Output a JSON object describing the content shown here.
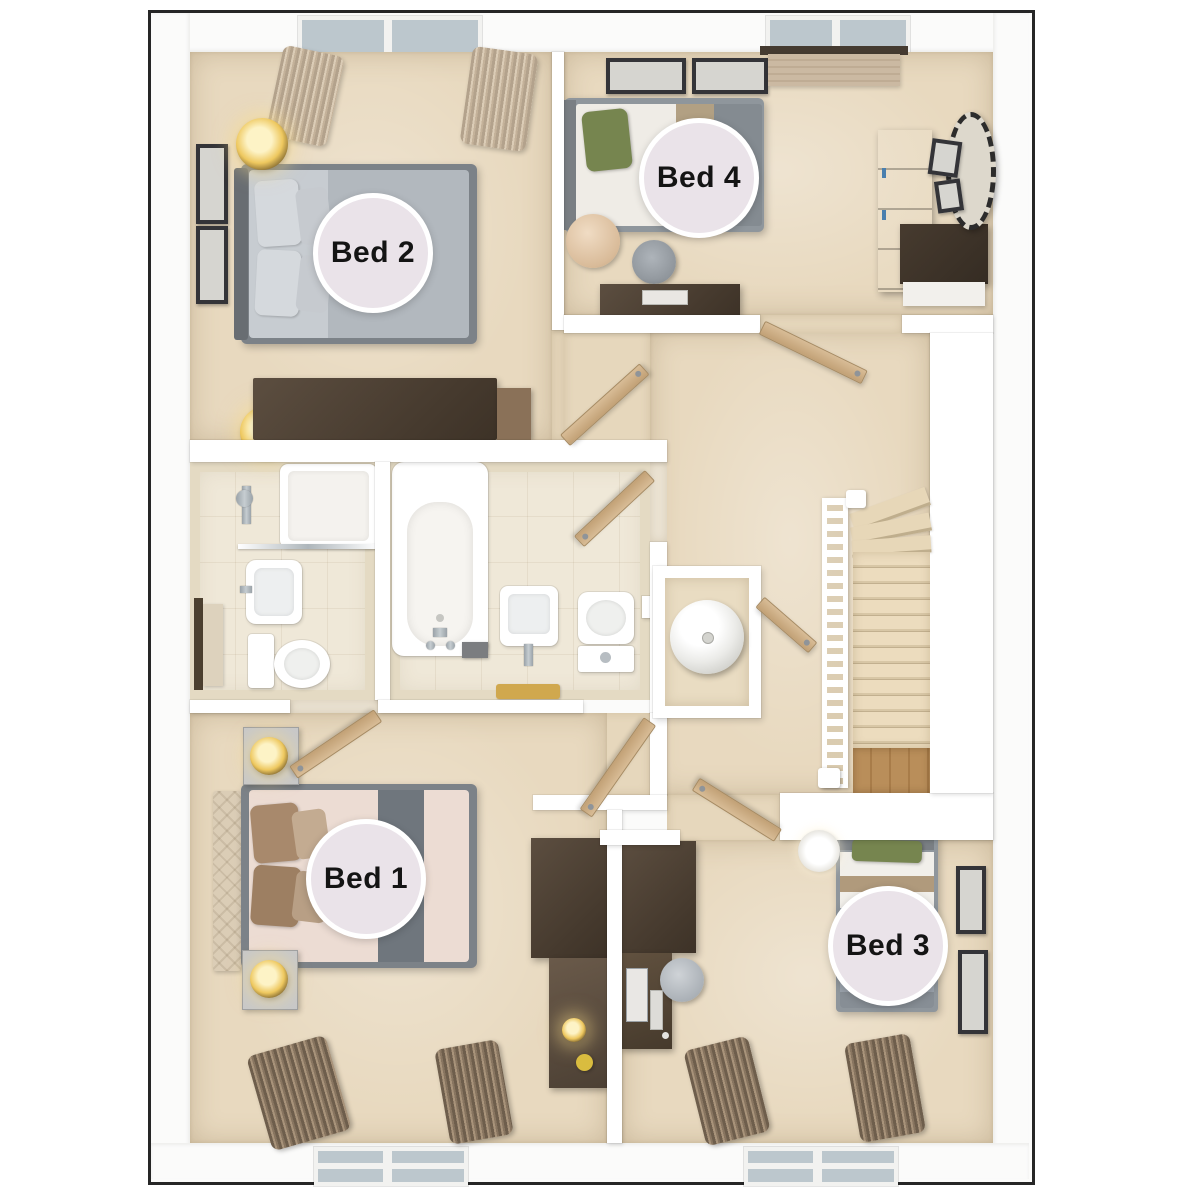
{
  "floor_plan": {
    "type": "3d-top-view-floor-plan",
    "room_labels": {
      "bed1": "Bed 1",
      "bed2": "Bed 2",
      "bed3": "Bed 3",
      "bed4": "Bed 4"
    },
    "colors": {
      "plan_border": "#262626",
      "wall": "#ffffff",
      "carpet": "#e8d9bf",
      "tile_floor": "#efe8d8",
      "door_wood": "#cdaf87",
      "furniture_dark_wood": "#4f4336",
      "stair_wood": "#b98e5a",
      "label_fill": "#eae3e9",
      "label_text": "#141414",
      "accent_green": "#76854f",
      "window_glass": "#bcc7cd"
    }
  }
}
